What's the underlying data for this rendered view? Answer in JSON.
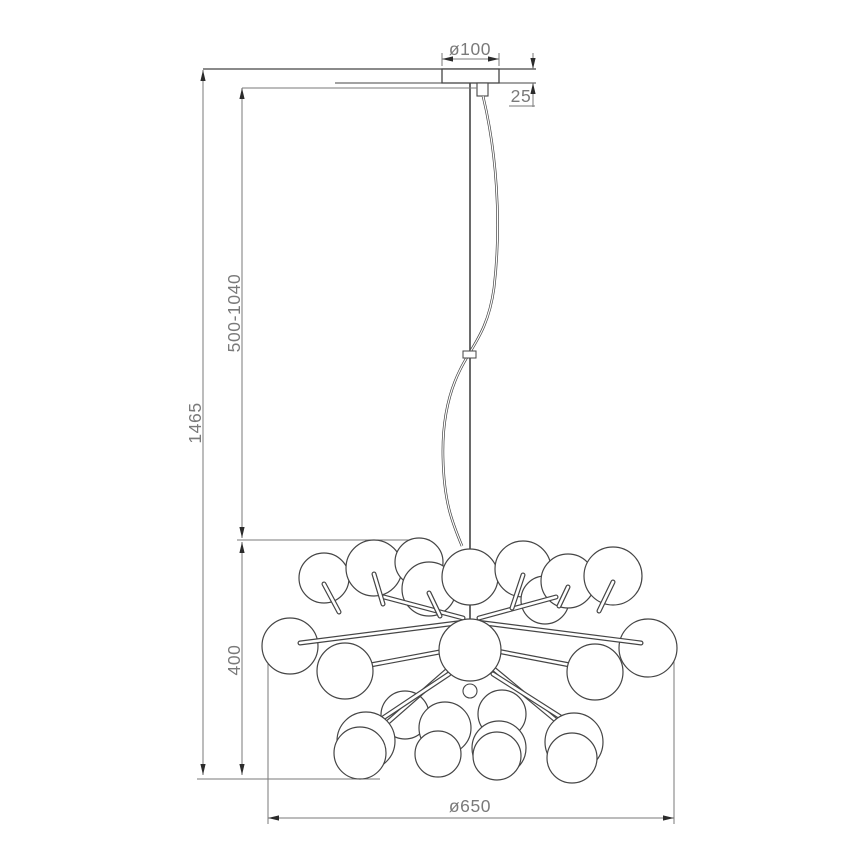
{
  "meta": {
    "title": "Pendant chandelier dimension drawing"
  },
  "dimensions": {
    "canopy_diameter": "ø100",
    "canopy_height": "25",
    "total_height": "1465",
    "suspension_range": "500-1040",
    "body_height": "400",
    "body_diameter": "ø650"
  },
  "colors": {
    "object_line": "#454545",
    "dim_line": "#7a7a7a",
    "arrow": "#2b2b2b",
    "text": "#7a7a7a",
    "background": "#ffffff",
    "sphere_fill": "#ffffff"
  },
  "drawing": {
    "spheres_back": [
      [
        324,
        578,
        25
      ],
      [
        374,
        568,
        28
      ],
      [
        419,
        562,
        24
      ],
      [
        429,
        589,
        27
      ],
      [
        470,
        577,
        28
      ],
      [
        523,
        569,
        28
      ],
      [
        545,
        600,
        24
      ],
      [
        568,
        581,
        27
      ],
      [
        613,
        576,
        29
      ],
      [
        405,
        715,
        24
      ],
      [
        502,
        714,
        24
      ],
      [
        290,
        646,
        28
      ],
      [
        648,
        648,
        29
      ]
    ],
    "spheres_front": [
      [
        345,
        671,
        28
      ],
      [
        595,
        672,
        28
      ],
      [
        366,
        741,
        29
      ],
      [
        360,
        753,
        26
      ],
      [
        445,
        728,
        26
      ],
      [
        438,
        754,
        23
      ],
      [
        499,
        748,
        27
      ],
      [
        497,
        756,
        24
      ],
      [
        574,
        742,
        29
      ],
      [
        572,
        758,
        25
      ],
      [
        470,
        650,
        31
      ]
    ],
    "rods": [
      [
        465,
        622,
        300,
        643
      ],
      [
        476,
        622,
        641,
        643
      ],
      [
        463,
        618,
        384,
        597
      ],
      [
        479,
        618,
        556,
        597
      ],
      [
        461,
        648,
        349,
        669
      ],
      [
        481,
        648,
        591,
        669
      ],
      [
        459,
        660,
        371,
        737
      ],
      [
        483,
        660,
        570,
        732
      ],
      [
        449,
        674,
        380,
        720
      ],
      [
        493,
        674,
        562,
        718
      ],
      [
        324,
        584,
        339,
        612
      ],
      [
        374,
        574,
        383,
        604
      ],
      [
        429,
        593,
        440,
        616
      ],
      [
        523,
        575,
        512,
        608
      ],
      [
        568,
        587,
        559,
        606
      ],
      [
        613,
        582,
        599,
        611
      ]
    ],
    "finial": [
      470,
      691,
      7
    ]
  }
}
